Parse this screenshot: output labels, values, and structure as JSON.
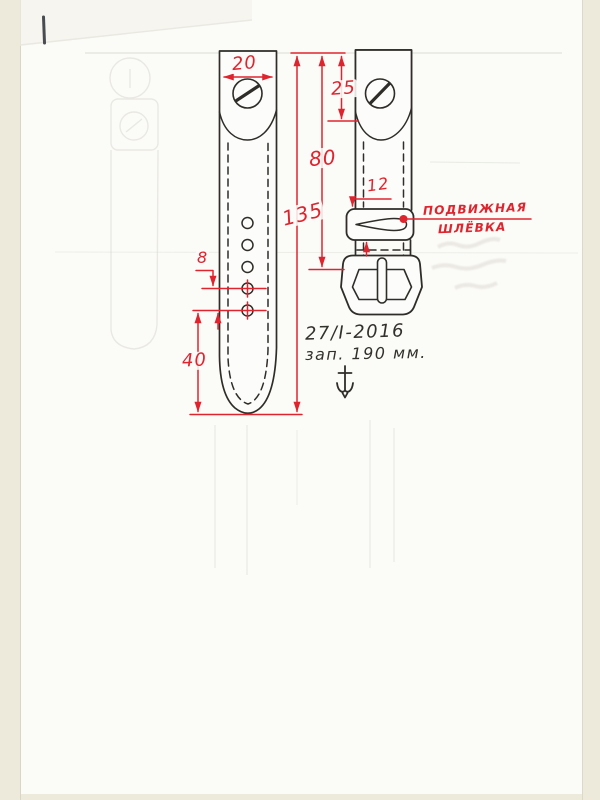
{
  "colors": {
    "dimension_red": "#e0242e",
    "ink_black": "#2f2d29",
    "paper_white": "#fbfbf8",
    "scan_edge_beige": "#edeadc"
  },
  "dimensions": {
    "strap_top_width": "20",
    "lug_tab_length": "25",
    "top_to_buckle_bar": "80",
    "strap_total_length": "135",
    "keeper_height": "12",
    "hole_pitch": "8",
    "tip_to_last_hole": "40"
  },
  "annotations": {
    "keeper_label_line1": "ПОДВИЖНАЯ",
    "keeper_label_line2": "ШЛЁВКА",
    "note_date": "27/I-2016",
    "note_length": "зап. 190 мм."
  },
  "icons": {
    "screw_head": "slotted-screw-head",
    "anchor_mark": "anchor",
    "keeper_slot": "teardrop-slot"
  }
}
